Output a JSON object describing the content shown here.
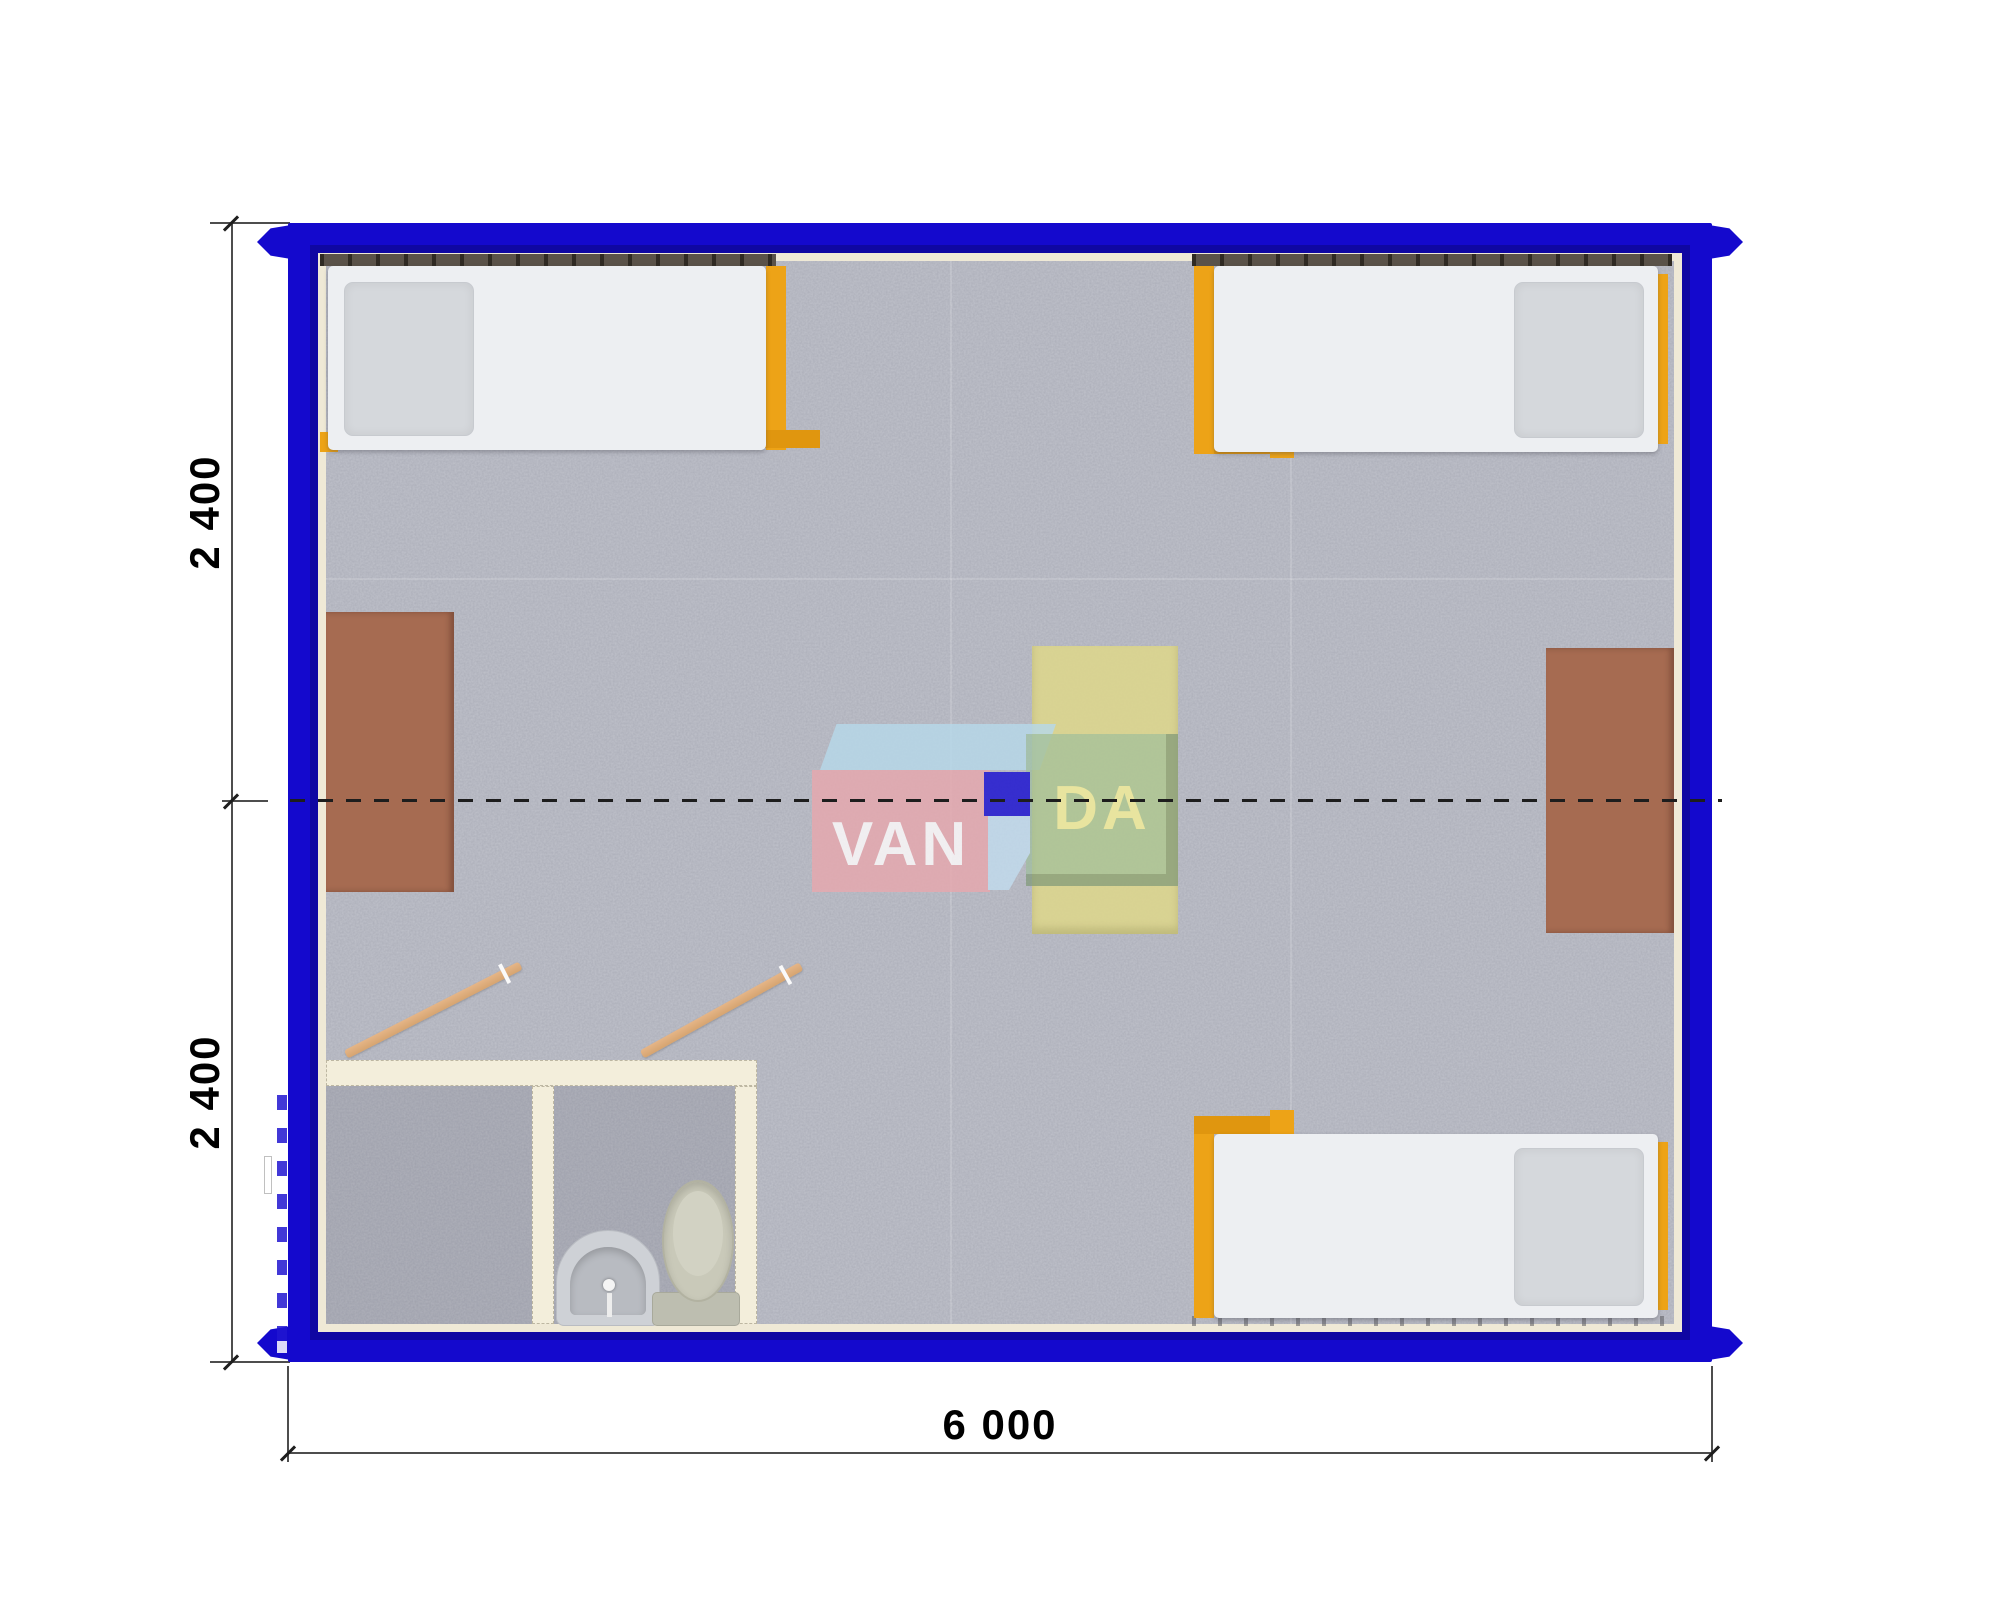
{
  "diagram": {
    "kind": "container-module-floor-plan",
    "brand": "VANDA"
  },
  "dimensions": {
    "height_top": "2 400",
    "height_bottom": "2 400",
    "width_bottom": "6 000"
  },
  "watermark": {
    "left_text": "VAN",
    "right_text": "DA"
  },
  "colors": {
    "frame_blue": "#1409cd",
    "floor_gray": "#b7b9c3",
    "inner_wall_cream": "#efe9d6",
    "bathroom_wall_cream": "#f3eedb",
    "bed_frame_orange": "#eda317",
    "desk_brown": "#a66b51",
    "center_table_yellow": "#dbd58e",
    "door_tan": "#ddad7d",
    "window_strip_dark": "#3a342c",
    "logo_pink": "#e7a8ae",
    "logo_blue": "#1a10d2",
    "logo_light_blue": "#b7d9ea",
    "logo_green": "#9ebe9b"
  },
  "inventory": {
    "beds": 3,
    "wall_desks": 2,
    "center_table": 1,
    "bathroom_rooms": 2,
    "toilet": 1,
    "sink": 1,
    "open_doors": 2
  }
}
